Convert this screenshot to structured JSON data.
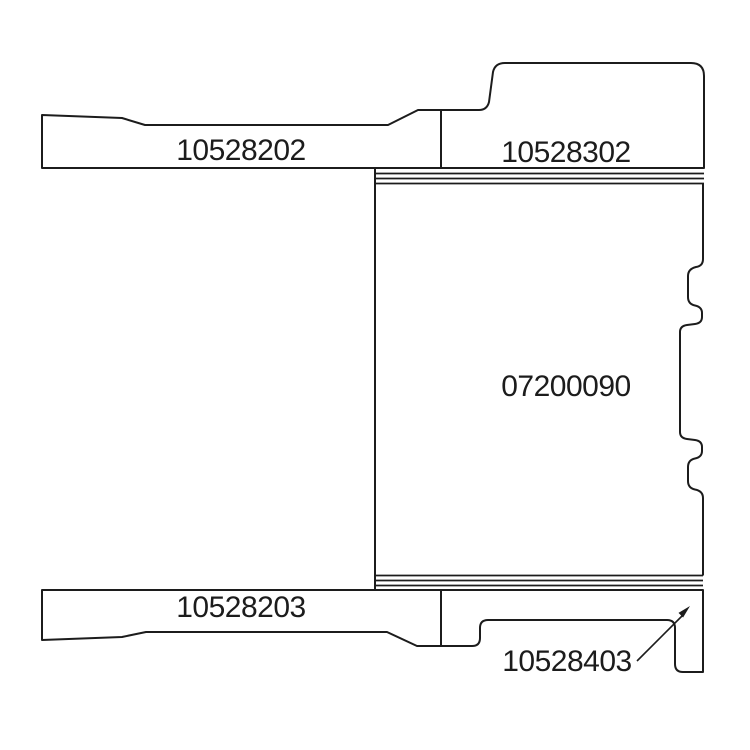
{
  "colors": {
    "line": "#1c1c1c",
    "text": "#1c1c1c",
    "background": "#ffffff"
  },
  "diagram": {
    "type": "technical-parts-diagram",
    "parts": {
      "top_left_bar": {
        "label": "10528202"
      },
      "top_right_cap": {
        "label": "10528302"
      },
      "center_body": {
        "label": "07200090"
      },
      "bottom_left_bar": {
        "label": "10528203"
      },
      "bottom_right_bracket": {
        "label": "10528403"
      }
    }
  }
}
